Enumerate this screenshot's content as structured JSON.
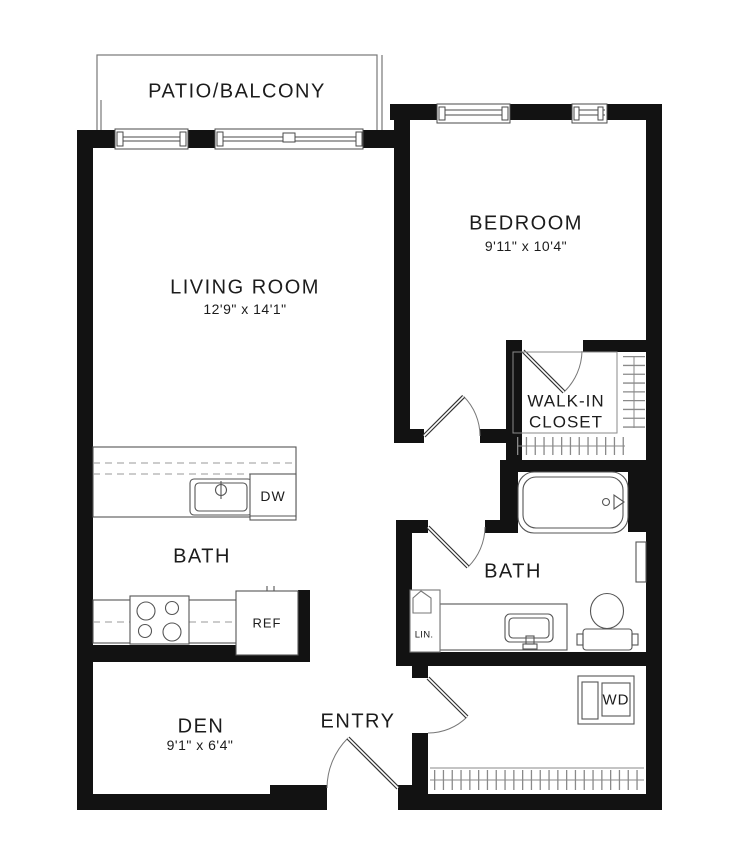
{
  "plan": {
    "type": "apartment-floorplan",
    "colors": {
      "wall": "#121212",
      "line": "#555555",
      "light_line": "#8a8a8a",
      "dashed": "#9a9a9a",
      "background": "#ffffff",
      "text": "#1c1c1c"
    },
    "rooms": {
      "patio": {
        "label": "PATIO/BALCONY"
      },
      "living_room": {
        "label": "LIVING ROOM",
        "dimensions": "12'9\" x 14'1\""
      },
      "bedroom": {
        "label": "BEDROOM",
        "dimensions": "9'11\" x 10'4\""
      },
      "walk_in_closet": {
        "label_line1": "WALK-IN",
        "label_line2": "CLOSET"
      },
      "kitchen_area": {
        "label": "BATH"
      },
      "bathroom": {
        "label": "BATH"
      },
      "den": {
        "label": "DEN",
        "dimensions": "9'1\" x 6'4\""
      },
      "entry": {
        "label": "ENTRY"
      }
    },
    "fixtures": {
      "dishwasher": {
        "label": "DW"
      },
      "refrigerator": {
        "label": "REF"
      },
      "linen_closet": {
        "label": "LIN."
      },
      "washer_dryer": {
        "label": "WD"
      }
    }
  }
}
